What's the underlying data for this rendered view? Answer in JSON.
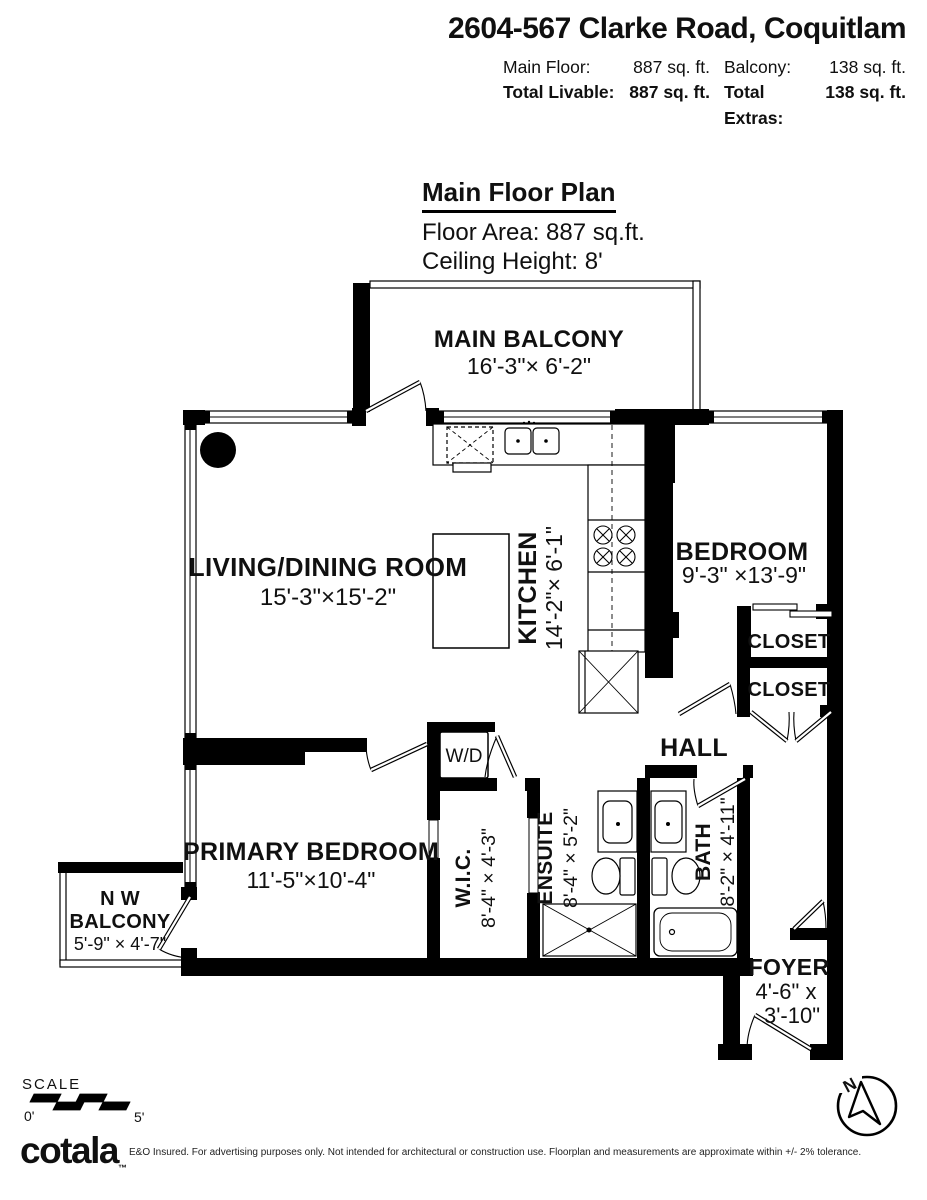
{
  "header": {
    "title": "2604-567 Clarke Road, Coquitlam",
    "row1": {
      "l1": "Main Floor:",
      "v1": "887 sq. ft.",
      "l2": "Balcony:",
      "v2": "138 sq. ft."
    },
    "row2": {
      "l1": "Total Livable:",
      "v1": "887 sq. ft.",
      "l2": "Total Extras:",
      "v2": "138 sq. ft."
    }
  },
  "plan_title": {
    "main": "Main Floor Plan",
    "area": "Floor Area: 887 sq.ft.",
    "ceiling": "Ceiling Height: 8'"
  },
  "rooms": {
    "main_balcony": {
      "name": "MAIN BALCONY",
      "dims": "16'-3\"×  6'-2\""
    },
    "living_dining": {
      "name": "LIVING/DINING ROOM",
      "dims": "15'-3\"×15'-2\""
    },
    "kitchen": {
      "name": "KITCHEN",
      "dims": "14'-2\"× 6'-1\""
    },
    "bedroom": {
      "name": "BEDROOM",
      "dims": "9'-3\" ×13'-9\""
    },
    "closet1": {
      "name": "CLOSET"
    },
    "closet2": {
      "name": "CLOSET"
    },
    "hall": {
      "name": "HALL"
    },
    "wd": {
      "name": "W/D"
    },
    "primary_bedroom": {
      "name": "PRIMARY BEDROOM",
      "dims": "11'-5\"×10'-4\""
    },
    "nw_balcony": {
      "name_line1": "N W",
      "name_line2": "BALCONY",
      "dims": "5'-9\" × 4'-7\""
    },
    "wic": {
      "name": "W.I.C.",
      "dims": "8'-4\" × 4'-3\""
    },
    "ensuite": {
      "name": "ENSUITE",
      "dims": "8'-4\" × 5'-2\""
    },
    "bath": {
      "name": "BATH",
      "dims": "8'-2\" × 4'-11\""
    },
    "foyer": {
      "name": "FOYER",
      "dims_line1": "4'-6\" x",
      "dims_line2": "3'-10\""
    }
  },
  "footer": {
    "scale_label": "SCALE",
    "scale_start": "0'",
    "scale_end": "5'",
    "logo": "cotala",
    "trademark": "™",
    "north": "N",
    "disclaimer": "E&O Insured. For advertising purposes only. Not intended for architectural or construction use. Floorplan and measurements are approximate within +/- 2% tolerance."
  }
}
